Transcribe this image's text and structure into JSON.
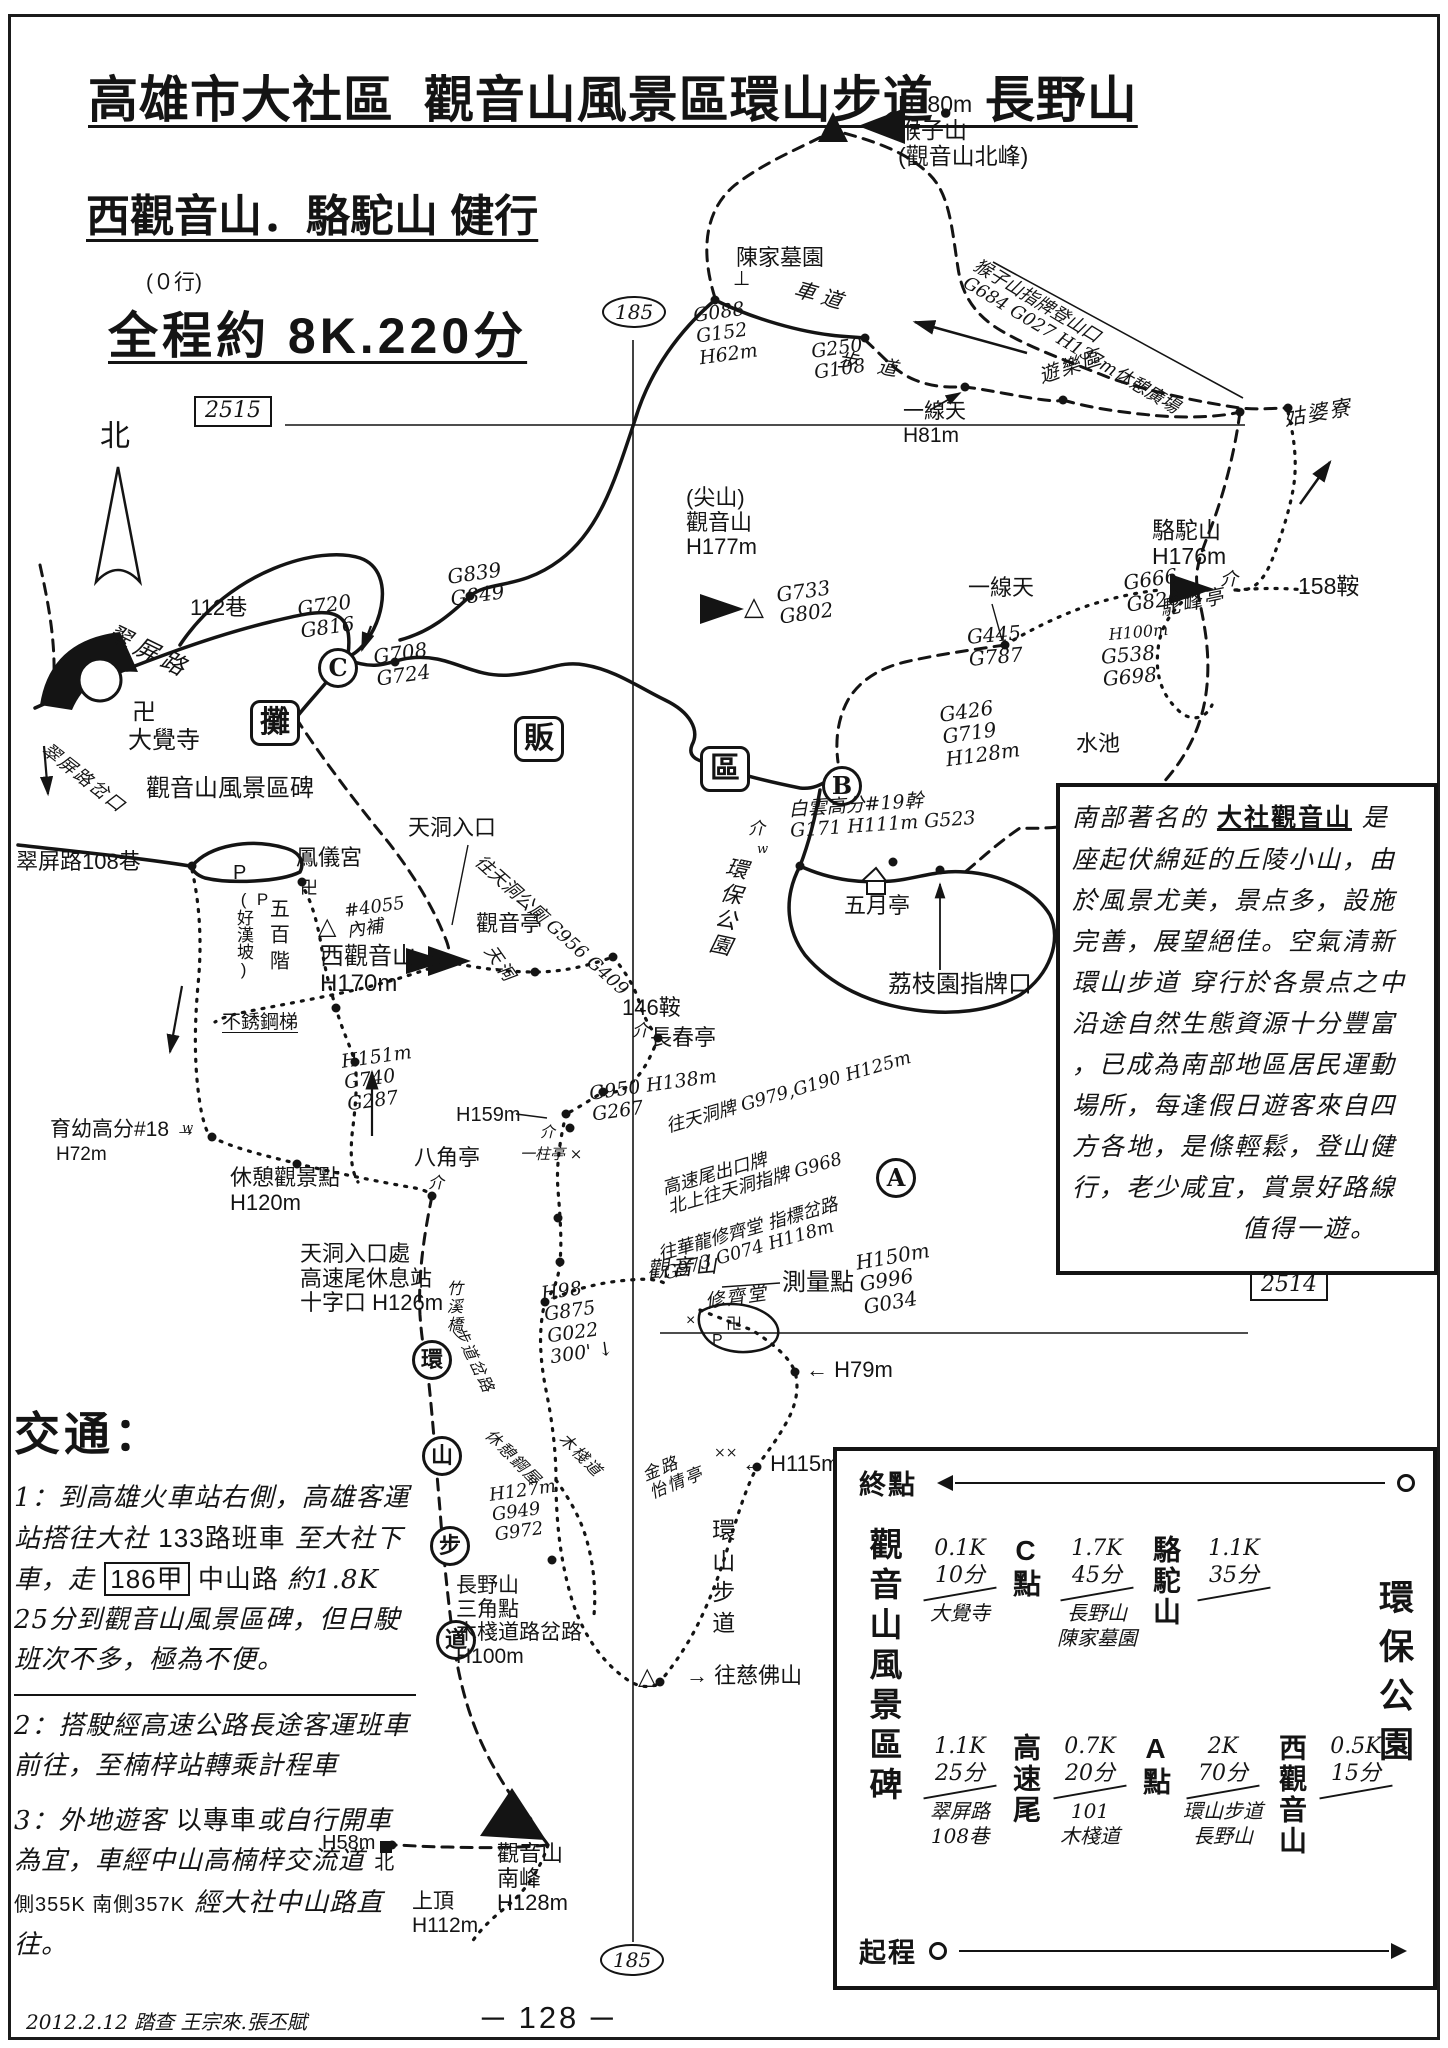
{
  "header": {
    "title1": "高雄市大社區  觀音山風景區環山步道．長野山",
    "title2": "西觀音山．駱駝山 健行",
    "note": "(０行)",
    "title3": "全程約 8K.220分"
  },
  "map": {
    "labels": [
      {
        "id": "peak-houzishan-note",
        "t": "H180m\n猴子山\n(觀音山北峰)",
        "x": 898,
        "y": 92,
        "fs": 23,
        "c": "p"
      },
      {
        "id": "tomb-chenjia",
        "t": "陳家墓園",
        "x": 736,
        "y": 246,
        "fs": 22,
        "c": "p"
      },
      {
        "id": "tomb-mark",
        "t": "⊥",
        "x": 733,
        "y": 268,
        "fs": 20,
        "c": "p"
      },
      {
        "id": "gps-g088",
        "t": "G088\nG152\nH62m",
        "x": 692,
        "y": 306,
        "fs": 19,
        "rot": -8,
        "c": "h"
      },
      {
        "id": "road-chedao",
        "t": "車 道",
        "x": 798,
        "y": 278,
        "fs": 21,
        "rot": 16,
        "c": "h"
      },
      {
        "id": "gps-g250",
        "t": "G250\nG108",
        "x": 810,
        "y": 342,
        "fs": 19,
        "rot": -8,
        "c": "h"
      },
      {
        "id": "trail-budao",
        "t": "步　道",
        "x": 840,
        "y": 348,
        "fs": 20,
        "rot": 10,
        "c": "h"
      },
      {
        "id": "trailhead-houzishan",
        "t": "猴子山指牌登山口\nG684 G027 H137m休憩廣場",
        "x": 980,
        "y": 256,
        "fs": 18,
        "rot": 31,
        "c": "h"
      },
      {
        "id": "area-youlequ",
        "t": "遊樂區",
        "x": 1036,
        "y": 366,
        "fs": 20,
        "rot": -18,
        "c": "s"
      },
      {
        "id": "place-gupoliao",
        "t": "姑婆寮",
        "x": 1282,
        "y": 408,
        "fs": 21,
        "rot": -10,
        "c": "s"
      },
      {
        "id": "gap-yixiantian-1",
        "t": "一線天\nH81m",
        "x": 903,
        "y": 400,
        "fs": 21,
        "c": "p"
      },
      {
        "id": "lane-112",
        "t": "112巷",
        "x": 190,
        "y": 596,
        "fs": 22,
        "c": "p"
      },
      {
        "id": "road-cuiping",
        "t": "翠屏路",
        "x": 114,
        "y": 620,
        "fs": 24,
        "rot": 26,
        "c": "h",
        "ls": 6
      },
      {
        "id": "gps-g720",
        "t": "G720\nG816",
        "x": 296,
        "y": 598,
        "fs": 20,
        "rot": -8,
        "c": "h"
      },
      {
        "id": "gps-g708",
        "t": "G708\nG724",
        "x": 372,
        "y": 646,
        "fs": 20,
        "rot": -8,
        "c": "h"
      },
      {
        "id": "gps-g839",
        "t": "G839\nG849",
        "x": 446,
        "y": 566,
        "fs": 20,
        "rot": -8,
        "c": "h"
      },
      {
        "id": "point-c",
        "t": "C",
        "x": 318,
        "y": 648,
        "fs": 24,
        "c": "circ"
      },
      {
        "id": "temple-swastika",
        "t": "卍",
        "x": 132,
        "y": 700,
        "fs": 24,
        "c": "p"
      },
      {
        "id": "temple-dajue",
        "t": "大覺寺",
        "x": 128,
        "y": 728,
        "fs": 24,
        "c": "p"
      },
      {
        "id": "stall-tan",
        "t": "攤",
        "x": 250,
        "y": 700,
        "fs": 30,
        "c": "box"
      },
      {
        "id": "stall-fan",
        "t": "販",
        "x": 514,
        "y": 716,
        "fs": 30,
        "c": "box"
      },
      {
        "id": "stall-qu",
        "t": "區",
        "x": 700,
        "y": 746,
        "fs": 30,
        "c": "box"
      },
      {
        "id": "point-b",
        "t": "B",
        "x": 822,
        "y": 766,
        "fs": 24,
        "c": "circ"
      },
      {
        "id": "stone-scenic",
        "t": "觀音山風景區碑",
        "x": 146,
        "y": 776,
        "fs": 24,
        "c": "p"
      },
      {
        "id": "fork-cuiping",
        "t": "翠屏路岔口",
        "x": 50,
        "y": 740,
        "fs": 18,
        "rot": 38,
        "c": "s"
      },
      {
        "id": "entr-tiandong",
        "t": "天洞入口",
        "x": 408,
        "y": 816,
        "fs": 22,
        "c": "p"
      },
      {
        "id": "pole-baiyun",
        "t": "白雲高分#19幹\nG171 H111m G523",
        "x": 788,
        "y": 800,
        "fs": 19,
        "rot": -4,
        "c": "h"
      },
      {
        "id": "park-huanbao-road",
        "t": "環保公園",
        "x": 724,
        "y": 854,
        "fs": 22,
        "rot": 12,
        "c": "h vert",
        "ls": 4
      },
      {
        "id": "sym-jie-1",
        "t": "介",
        "x": 748,
        "y": 820,
        "fs": 17,
        "c": "h"
      },
      {
        "id": "sym-w-1",
        "t": "w",
        "x": 757,
        "y": 843,
        "fs": 13,
        "c": "h"
      },
      {
        "id": "pav-may",
        "t": "五月亭",
        "x": 844,
        "y": 894,
        "fs": 22,
        "c": "p"
      },
      {
        "id": "sign-lychee",
        "t": "荔枝園指牌口",
        "x": 888,
        "y": 972,
        "fs": 24,
        "c": "p"
      },
      {
        "id": "saddle-146",
        "t": "146鞍",
        "x": 622,
        "y": 996,
        "fs": 22,
        "c": "p"
      },
      {
        "id": "sym-jie-2",
        "t": "介",
        "x": 632,
        "y": 1022,
        "fs": 17,
        "c": "h"
      },
      {
        "id": "pav-changchun",
        "t": "長春亭",
        "x": 650,
        "y": 1026,
        "fs": 22,
        "c": "p"
      },
      {
        "id": "peak-jianshan",
        "t": "(尖山)\n觀音山\nH177m",
        "x": 686,
        "y": 486,
        "fs": 22,
        "c": "p"
      },
      {
        "id": "tri-jianshan",
        "t": "△",
        "x": 744,
        "y": 592,
        "fs": 26,
        "c": "p"
      },
      {
        "id": "gps-g733",
        "t": "G733\nG802",
        "x": 775,
        "y": 584,
        "fs": 20,
        "rot": -8,
        "c": "h"
      },
      {
        "id": "gap-yixiantian-2",
        "t": "一線天",
        "x": 968,
        "y": 576,
        "fs": 22,
        "c": "p"
      },
      {
        "id": "gps-g445",
        "t": "G445\nG787",
        "x": 966,
        "y": 626,
        "fs": 20,
        "rot": -5,
        "c": "h"
      },
      {
        "id": "peak-luotuo",
        "t": "駱駝山\nH176m",
        "x": 1152,
        "y": 518,
        "fs": 23,
        "c": "p"
      },
      {
        "id": "gps-g666",
        "t": "G666\nG826",
        "x": 1122,
        "y": 572,
        "fs": 20,
        "rot": -8,
        "c": "h"
      },
      {
        "id": "pav-tuofeng",
        "t": "駝峰亭",
        "x": 1158,
        "y": 598,
        "fs": 20,
        "rot": -12,
        "c": "s"
      },
      {
        "id": "saddle-158",
        "t": "158鞍",
        "x": 1298,
        "y": 574,
        "fs": 23,
        "c": "p"
      },
      {
        "id": "sym-jie-3",
        "t": "介",
        "x": 1220,
        "y": 570,
        "fs": 18,
        "c": "h"
      },
      {
        "id": "gps-h100-right",
        "t": "H100m",
        "x": 1108,
        "y": 626,
        "fs": 16,
        "rot": -5,
        "c": "h"
      },
      {
        "id": "gps-g538",
        "t": "G538\nG698",
        "x": 1100,
        "y": 646,
        "fs": 20,
        "rot": -5,
        "c": "h"
      },
      {
        "id": "pond-shuichi",
        "t": "水池",
        "x": 1076,
        "y": 732,
        "fs": 22,
        "c": "p"
      },
      {
        "id": "gps-g426",
        "t": "G426\nG719\nH128m",
        "x": 938,
        "y": 704,
        "fs": 20,
        "rot": -8,
        "c": "h"
      },
      {
        "id": "pav-guanyin",
        "t": "觀音亭",
        "x": 476,
        "y": 912,
        "fs": 22,
        "c": "p"
      },
      {
        "id": "scrib-tiandong",
        "t": "天洞",
        "x": 496,
        "y": 942,
        "fs": 18,
        "rot": 55,
        "c": "s"
      },
      {
        "id": "sign-wc",
        "t": "往天洞公廁 G956 G409",
        "x": 484,
        "y": 852,
        "fs": 18,
        "rot": 42,
        "c": "h"
      },
      {
        "id": "note-4055",
        "t": "#4055\n內補",
        "x": 343,
        "y": 902,
        "fs": 18,
        "rot": -8,
        "c": "h"
      },
      {
        "id": "tri-xiguanyin",
        "t": "△",
        "x": 318,
        "y": 914,
        "fs": 24,
        "c": "p"
      },
      {
        "id": "peak-xiguanyin",
        "t": "西觀音山\nH170m",
        "x": 320,
        "y": 944,
        "fs": 24,
        "c": "p"
      },
      {
        "id": "temple-fengyi",
        "t": "鳳儀宮",
        "x": 296,
        "y": 846,
        "fs": 22,
        "c": "p"
      },
      {
        "id": "park-p",
        "t": "P",
        "x": 233,
        "y": 862,
        "fs": 20,
        "c": "p"
      },
      {
        "id": "slope-haohan",
        "t": "P\n(好漢坡)",
        "x": 234,
        "y": 890,
        "fs": 17,
        "c": "p vert"
      },
      {
        "id": "stairs-500",
        "t": "五百階",
        "x": 266,
        "y": 898,
        "fs": 20,
        "c": "p vert",
        "ls": 6
      },
      {
        "id": "sym-swastika-2",
        "t": "卍",
        "x": 300,
        "y": 878,
        "fs": 18,
        "c": "p"
      },
      {
        "id": "stairs-steel",
        "t": "不銹鋼梯",
        "x": 222,
        "y": 1012,
        "fs": 19,
        "c": "p",
        "u": 1
      },
      {
        "id": "lane-108",
        "t": "翠屏路108巷",
        "x": 16,
        "y": 850,
        "fs": 22,
        "c": "p"
      },
      {
        "id": "gps-h151",
        "t": "H151m\nG740\nG287",
        "x": 340,
        "y": 1052,
        "fs": 19,
        "rot": -8,
        "c": "h"
      },
      {
        "id": "pole-yuyou",
        "t": "育幼高分#18 →",
        "x": 50,
        "y": 1118,
        "fs": 21,
        "c": "p"
      },
      {
        "id": "gps-h72",
        "t": "H72m",
        "x": 56,
        "y": 1144,
        "fs": 19,
        "c": "p"
      },
      {
        "id": "sym-w-2",
        "t": "w",
        "x": 182,
        "y": 1122,
        "fs": 13,
        "c": "h"
      },
      {
        "id": "view-rest",
        "t": "休憩觀景點\nH120m",
        "x": 230,
        "y": 1166,
        "fs": 22,
        "c": "p"
      },
      {
        "id": "pav-octagon",
        "t": "八角亭",
        "x": 414,
        "y": 1146,
        "fs": 22,
        "c": "p"
      },
      {
        "id": "sym-jie-4",
        "t": "介",
        "x": 428,
        "y": 1174,
        "fs": 16,
        "c": "h"
      },
      {
        "id": "rest-tiandong",
        "t": "天洞入口處\n高速尾休息站\n十字口 H126m",
        "x": 300,
        "y": 1242,
        "fs": 22,
        "c": "p"
      },
      {
        "id": "ring-huan",
        "t": "環",
        "x": 412,
        "y": 1340,
        "fs": 22,
        "c": "circ"
      },
      {
        "id": "ring-shan",
        "t": "山",
        "x": 422,
        "y": 1436,
        "fs": 22,
        "c": "circ"
      },
      {
        "id": "ring-bu",
        "t": "步",
        "x": 430,
        "y": 1526,
        "fs": 22,
        "c": "circ"
      },
      {
        "id": "ring-dao",
        "t": "道",
        "x": 436,
        "y": 1620,
        "fs": 22,
        "c": "circ"
      },
      {
        "id": "gps-h159",
        "t": "H159m",
        "x": 456,
        "y": 1104,
        "fs": 20,
        "c": "p"
      },
      {
        "id": "pav-yizhu",
        "t": "一柱亭 ×",
        "x": 520,
        "y": 1146,
        "fs": 15,
        "c": "h"
      },
      {
        "id": "sym-jie-5",
        "t": "介",
        "x": 540,
        "y": 1124,
        "fs": 15,
        "c": "h"
      },
      {
        "id": "gps-g950",
        "t": "G950 H138m\nG267",
        "x": 588,
        "y": 1084,
        "fs": 19,
        "rot": -8,
        "c": "h"
      },
      {
        "id": "sign-diag-1",
        "t": "往天洞牌 G979,G190 H125m",
        "x": 664,
        "y": 1118,
        "fs": 18,
        "rot": -16,
        "c": "h"
      },
      {
        "id": "sign-diag-2",
        "t": "高速尾出口牌\n北上往天洞指牌 G968",
        "x": 660,
        "y": 1180,
        "fs": 18,
        "rot": -16,
        "c": "h"
      },
      {
        "id": "sign-diag-3",
        "t": "往華龍修齊堂 指標岔路\nG973 G074 H118m",
        "x": 656,
        "y": 1246,
        "fs": 18,
        "rot": -16,
        "c": "h"
      },
      {
        "id": "point-a",
        "t": "A",
        "x": 876,
        "y": 1158,
        "fs": 24,
        "c": "circ"
      },
      {
        "id": "scrib-guanyinshan",
        "t": "觀音山",
        "x": 646,
        "y": 1260,
        "fs": 22,
        "rot": -5,
        "c": "s"
      },
      {
        "id": "survey-point",
        "t": "測量點",
        "x": 782,
        "y": 1270,
        "fs": 24,
        "c": "p"
      },
      {
        "id": "gps-h150",
        "t": "H150m\nG996\nG034",
        "x": 854,
        "y": 1252,
        "fs": 20,
        "rot": -10,
        "c": "h"
      },
      {
        "id": "hall-xiuqitang",
        "t": "修齊堂",
        "x": 704,
        "y": 1292,
        "fs": 19,
        "rot": -8,
        "c": "s"
      },
      {
        "id": "sym-swastika-3",
        "t": "卍",
        "x": 726,
        "y": 1316,
        "fs": 16,
        "c": "p"
      },
      {
        "id": "park-p-2",
        "t": "P",
        "x": 712,
        "y": 1332,
        "fs": 16,
        "c": "p"
      },
      {
        "id": "sym-x-1",
        "t": "×",
        "x": 686,
        "y": 1312,
        "fs": 16,
        "c": "p"
      },
      {
        "id": "gps-h79",
        "t": "← H79m",
        "x": 806,
        "y": 1358,
        "fs": 22,
        "c": "p"
      },
      {
        "id": "bridge-zhuxi",
        "t": "竹溪橋",
        "x": 444,
        "y": 1280,
        "fs": 16,
        "c": "s vert"
      },
      {
        "id": "fork-budao",
        "t": "步道岔路",
        "x": 466,
        "y": 1324,
        "fs": 16,
        "rot": 64,
        "c": "s"
      },
      {
        "id": "gps-h98",
        "t": "H98\nG875\nG022\n300' ↓",
        "x": 540,
        "y": 1284,
        "fs": 19,
        "rot": -8,
        "c": "h"
      },
      {
        "id": "hut-rest-steel",
        "t": "休憩鋼屋",
        "x": 494,
        "y": 1426,
        "fs": 16,
        "rot": 45,
        "c": "s"
      },
      {
        "id": "walk-wood",
        "t": "木棧道",
        "x": 568,
        "y": 1430,
        "fs": 16,
        "rot": 45,
        "c": "s"
      },
      {
        "id": "gps-h127",
        "t": "H127m\nG949\nG972",
        "x": 488,
        "y": 1486,
        "fs": 18,
        "rot": -8,
        "c": "h"
      },
      {
        "id": "nagano-tri",
        "t": "長野山\n三角點\n木棧道路岔路\nH100m",
        "x": 456,
        "y": 1574,
        "fs": 21,
        "c": "p"
      },
      {
        "id": "pav-jinlu",
        "t": "金路\n怡情亭",
        "x": 640,
        "y": 1468,
        "fs": 17,
        "rot": -22,
        "c": "s"
      },
      {
        "id": "trail-ring-south",
        "t": "環山步道",
        "x": 708,
        "y": 1518,
        "fs": 23,
        "c": "p vert",
        "ls": 8
      },
      {
        "id": "gps-h115",
        "t": "← H115m",
        "x": 742,
        "y": 1452,
        "fs": 22,
        "c": "p"
      },
      {
        "id": "sym-xx",
        "t": "××",
        "x": 714,
        "y": 1446,
        "fs": 14,
        "c": "h"
      },
      {
        "id": "to-cifoshan",
        "t": "→ 往慈佛山",
        "x": 686,
        "y": 1664,
        "fs": 22,
        "c": "p"
      },
      {
        "id": "tri-cifo",
        "t": "△",
        "x": 638,
        "y": 1664,
        "fs": 24,
        "c": "p"
      },
      {
        "id": "peak-south",
        "t": "觀音山\n南峰\nH128m",
        "x": 497,
        "y": 1842,
        "fs": 22,
        "c": "p"
      },
      {
        "id": "gps-h58",
        "t": "H58m",
        "x": 322,
        "y": 1832,
        "fs": 20,
        "c": "p"
      },
      {
        "id": "top-shangding",
        "t": "上頂\nH112m",
        "x": 412,
        "y": 1890,
        "fs": 21,
        "c": "p"
      },
      {
        "id": "north-label",
        "t": "北",
        "x": 100,
        "y": 420,
        "fs": 30,
        "c": "p"
      },
      {
        "id": "grid-2515",
        "t": "2515",
        "x": 194,
        "y": 396,
        "fs": 22,
        "c": "rbox"
      },
      {
        "id": "grid-2514",
        "t": "2514",
        "x": 1250,
        "y": 1270,
        "fs": 22,
        "c": "rbox"
      },
      {
        "id": "route-185-top",
        "t": "185",
        "x": 602,
        "y": 296,
        "fs": 20,
        "c": "oval"
      },
      {
        "id": "route-185-bottom",
        "t": "185",
        "x": 600,
        "y": 1944,
        "fs": 20,
        "c": "oval"
      }
    ]
  },
  "desc": {
    "l1a": "南部著名的 ",
    "l1b": "大社觀音山",
    "l1c": " 是",
    "lines": [
      "座起伏綿延的丘陵小山，由",
      "於風景尤美，景点多，設施",
      "完善，展望絕佳。空氣清新",
      "環山步道 穿行於各景点之中",
      "沿途自然生態資源十分豐富",
      "，已成為南部地區居民運動",
      "場所，每逢假日遊客來自四",
      "方各地，是條輕鬆，登山健",
      "行，老少咸宜，賞景好路線"
    ],
    "last_line": "值得一遊。"
  },
  "traffic": {
    "heading": "交通：",
    "i1a": "1：到高雄火車站右側，高雄客運站搭往大社 ",
    "i1b": "133路班車",
    "i1c": " 至大社下車，走 ",
    "i1d": "186甲",
    "i1e": " 中山路 ",
    "i1f": "約1.8K 25分到觀音山風景區碑，但日駛班次不多，極為不便。",
    "item2": "2：搭駛經高速公路長途客運班車前往，至楠梓站轉乘計程車",
    "i3a": "3：外地遊客 ",
    "i3b": "以專車",
    "i3c": "或自行開車為宜，車經中山高楠梓交流道 ",
    "i3d": "北側355K 南側357K",
    "i3e": " 經大社中山路直往。"
  },
  "route_diagram": {
    "end_label": "終點",
    "start_label": "起程",
    "left_vertical": "觀音山風景區碑",
    "right_vertical": "環保公園",
    "rows": [
      [
        {
          "d": "0.1K",
          "t": "10分",
          "via": "大覺寺",
          "node": "C點"
        },
        {
          "d": "1.7K",
          "t": "45分",
          "via": "長野山\n陳家墓園",
          "node": "駱駝山"
        },
        {
          "d": "1.1K",
          "t": "35分",
          "via": "",
          "node": ""
        }
      ],
      [
        {
          "d": "1.1K",
          "t": "25分",
          "via": "翠屏路\n108巷",
          "node": "高速尾"
        },
        {
          "d": "0.7K",
          "t": "20分",
          "via": "101\n木棧道",
          "node": "A點"
        },
        {
          "d": "2K",
          "t": "70分",
          "via": "環山步道\n長野山",
          "node": "西觀音山"
        },
        {
          "d": "0.5K",
          "t": "15分",
          "via": "",
          "node": ""
        }
      ]
    ]
  },
  "footer": {
    "survey": "2012.2.12 踏查 王宗來.張丕賦",
    "page_number": "─ 128 ─"
  }
}
